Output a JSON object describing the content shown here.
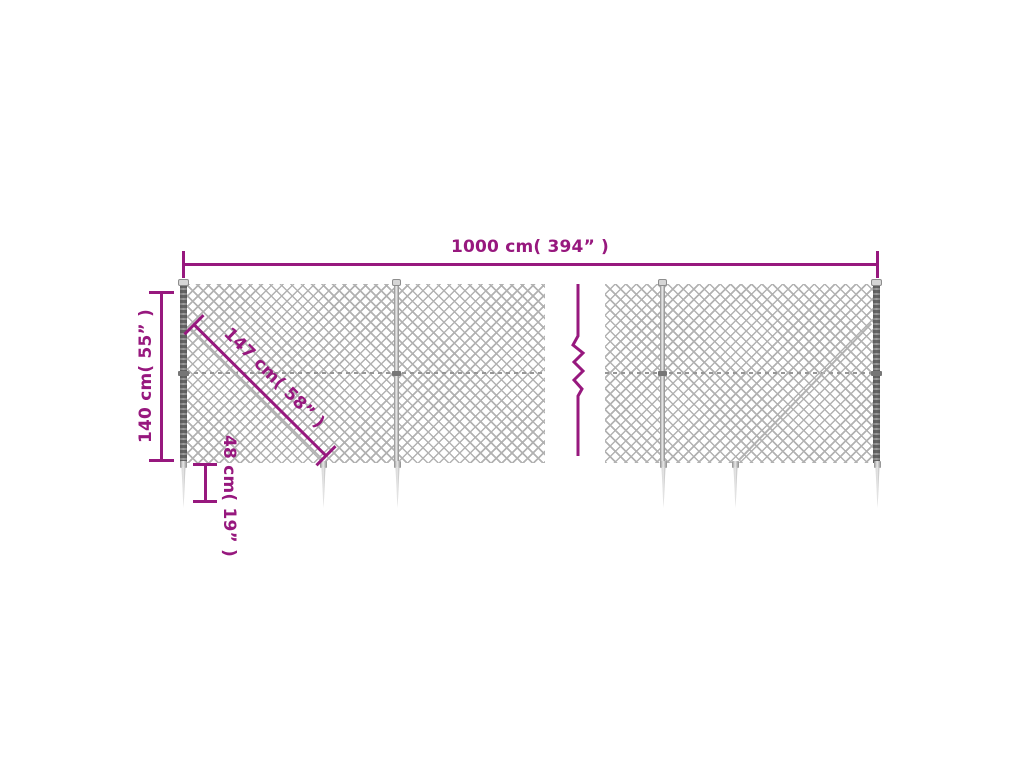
{
  "colors": {
    "accent": "#97187e",
    "mesh_gray": "#a2a2a2",
    "metal_light": "#ededed",
    "metal_dark": "#5f5f5f",
    "background": "#ffffff"
  },
  "dimensions": {
    "total_width": {
      "label": "1000 cm( 394” )"
    },
    "height": {
      "label": "140 cm( 55” )"
    },
    "diagonal": {
      "label": "147 cm( 58” )"
    },
    "spike": {
      "label": "48 cm( 19” )"
    }
  },
  "icons": {
    "break_symbol": "zigzag-break"
  }
}
